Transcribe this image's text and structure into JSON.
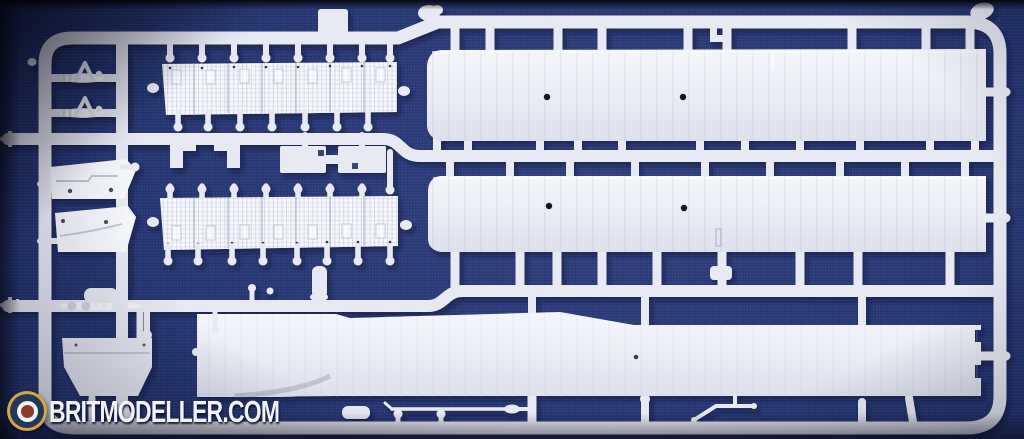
{
  "image_alt": "Photograph of a white injection-moulded plastic model kit sprue on dark blue cloth, containing two long wing halves, a long fuselage half, two corrugated radiator strips, cowling panels, a fuel tank and many small struts",
  "watermark": {
    "text": "BRITMODELLER.COM",
    "logo": "RAF-style roundel"
  },
  "colors": {
    "background": "#233470",
    "background_deep": "#101c4a",
    "plastic": "#e8eaf3",
    "plastic_bright": "#f7f8fc",
    "plastic_shadow": "#d3d7e7",
    "cast_shadow": "#081034",
    "locating_hole": "#16161e",
    "logo_gold": "#d8a43c",
    "logo_navy": "#1f3a58",
    "logo_white": "#f2f2f2",
    "logo_center": "#8d3c2a",
    "watermark_text": "#f2f3f6"
  },
  "parts": {
    "upper_wing": "upper wing half",
    "lower_wing": "lower wing half",
    "fuselage": "fuselage half",
    "radiator_strip_top": "corrugated radiator strip",
    "radiator_strip_bottom": "corrugated radiator strip",
    "cowl_panel_1": "cowling side panel",
    "cowl_panel_2": "cowling side panel",
    "fuel_tank": "fuel tank",
    "a_frame_struts": "A-frame strut pair",
    "small_struts": "interplane struts and rods"
  }
}
